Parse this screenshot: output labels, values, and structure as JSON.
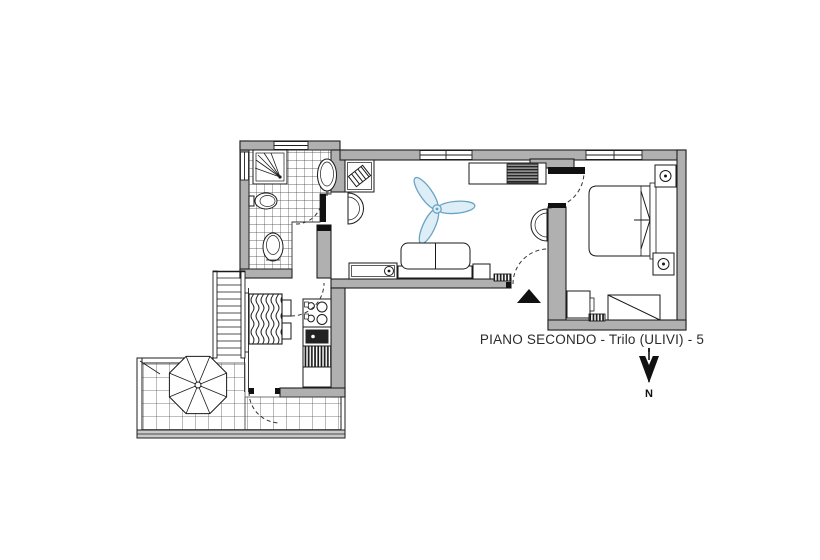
{
  "plan": {
    "title": "PIANO SECONDO - Trilo (ULIVI) - 5"
  },
  "compass": {
    "label": "N"
  },
  "colors": {
    "wall_fill": "#b0b0b0",
    "outline": "#1f1f1f",
    "fan_accent": "#6aa3c4",
    "fan_fill": "#ddeef7",
    "background": "#ffffff"
  },
  "icons": [
    "shower-icon",
    "bidet-icon",
    "washbasin-icon",
    "toilet-icon",
    "washing-machine-icon",
    "ceiling-fan-icon",
    "sofa-icon",
    "tv-unit-icon",
    "wardrobe-icon",
    "double-bed-icon",
    "nightstand-lamp-icon",
    "dresser-icon",
    "single-bed-icon",
    "dining-table-icon",
    "hob-icon",
    "kitchen-sink-icon",
    "dishwasher-icon",
    "umbrella-icon",
    "north-arrow-icon",
    "entrance-arrow-icon",
    "door-swing-icon",
    "radiator-icon",
    "staircase-icon"
  ]
}
